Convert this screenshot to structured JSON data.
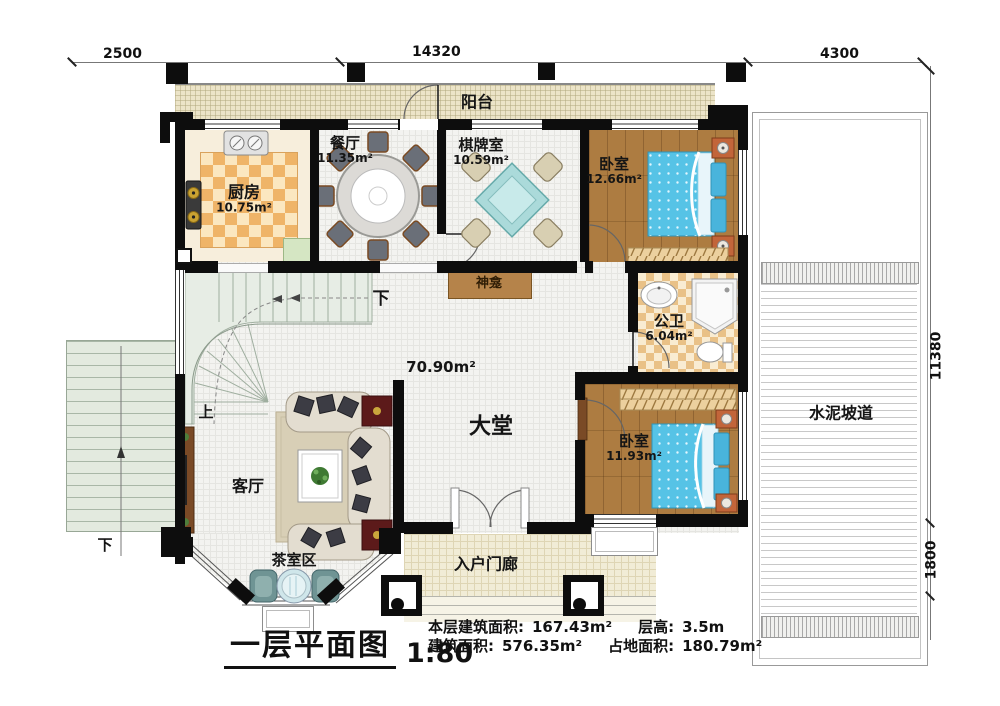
{
  "title": {
    "text": "一层平面图",
    "scale": "1:80"
  },
  "stats": {
    "items": [
      {
        "label": "本层建筑面积:",
        "value": "167.43m²"
      },
      {
        "label": "层高:",
        "value": "3.5m"
      },
      {
        "label": "建筑面积:",
        "value": "576.35m²"
      },
      {
        "label": "占地面积:",
        "value": "180.79m²"
      }
    ]
  },
  "dimensions": {
    "top": [
      "2500",
      "14320",
      "4300"
    ],
    "right": [
      "11380",
      "1800"
    ]
  },
  "rooms": {
    "balcony": {
      "name": "阳台"
    },
    "kitchen": {
      "name": "厨房",
      "area": "10.75m²"
    },
    "dining": {
      "name": "餐厅",
      "area": "11.35m²"
    },
    "games": {
      "name": "棋牌室",
      "area": "10.59m²"
    },
    "bedroom1": {
      "name": "卧室",
      "area": "12.66m²"
    },
    "bath": {
      "name": "公卫",
      "area": "6.04m²"
    },
    "bedroom2": {
      "name": "卧室",
      "area": "11.93m²"
    },
    "hall": {
      "name": "大堂",
      "area": "70.90m²"
    },
    "living": {
      "name": "客厅"
    },
    "tea": {
      "name": "茶室区"
    },
    "porch": {
      "name": "入户门廊"
    },
    "ramp": {
      "name": "水泥坡道"
    },
    "shrine": {
      "name": "神龛"
    }
  },
  "stairs": {
    "up": "上",
    "down": "下",
    "down_exterior": "下"
  },
  "palette": {
    "bed": "#56c3e6",
    "wood": "#ad7c41",
    "checker": "#efb468",
    "wall": "#0d0d0d"
  }
}
